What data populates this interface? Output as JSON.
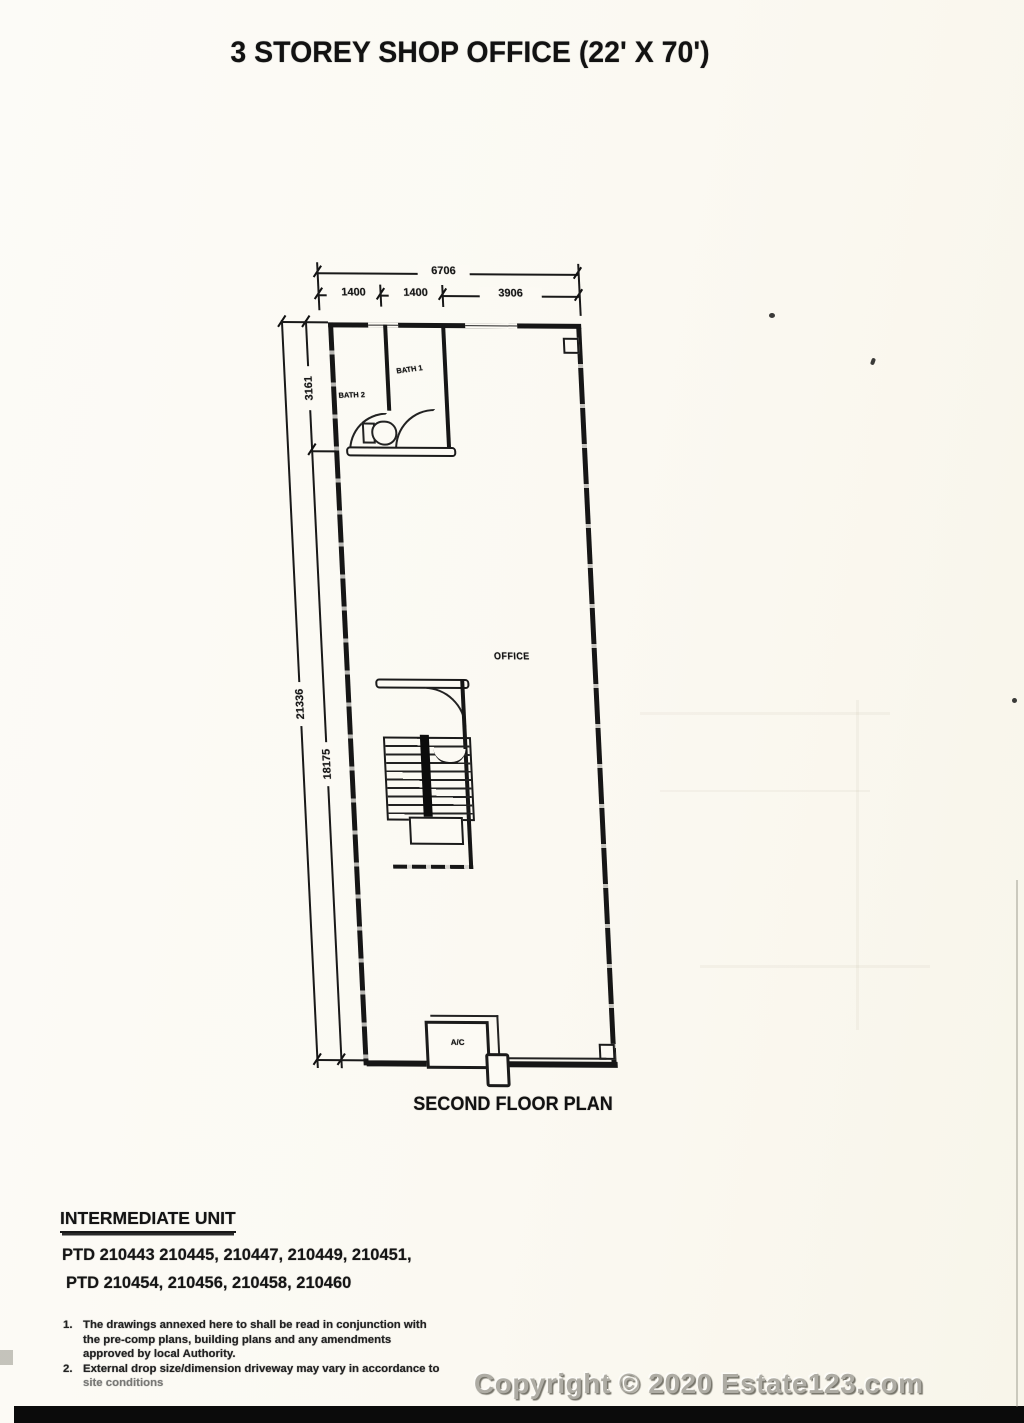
{
  "page": {
    "title": "3 STOREY SHOP OFFICE (22' X 70')",
    "caption": "SECOND FLOOR PLAN",
    "watermark": "Copyright © 2020 Estate123.com"
  },
  "plan": {
    "labels": {
      "bath2": "BATH 2",
      "bath1": "BATH 1",
      "office": "OFFICE",
      "ac": "A/C"
    },
    "dims": {
      "top_total": "6706",
      "top_segments": [
        "1400",
        "1400",
        "3906"
      ],
      "left_total": "21336",
      "left_upper": "3161",
      "left_lower": "18175"
    }
  },
  "footer": {
    "heading": "INTERMEDIATE UNIT",
    "ptd1": "PTD 210443 210445, 210447, 210449, 210451,",
    "ptd2": "PTD 210454, 210456, 210458, 210460",
    "notes": [
      {
        "num": "1.",
        "lines": [
          "The drawings annexed here to shall be read in conjunction with",
          "the pre-comp plans, building plans and any amendments",
          "approved by local Authority."
        ]
      },
      {
        "num": "2.",
        "lines": [
          "External drop size/dimension driveway may vary in accordance to",
          "site conditions"
        ]
      }
    ]
  },
  "colors": {
    "ink": "#1c1c1c",
    "paper": "#fcfaf4",
    "watermark_grey": "#aeaca4"
  }
}
